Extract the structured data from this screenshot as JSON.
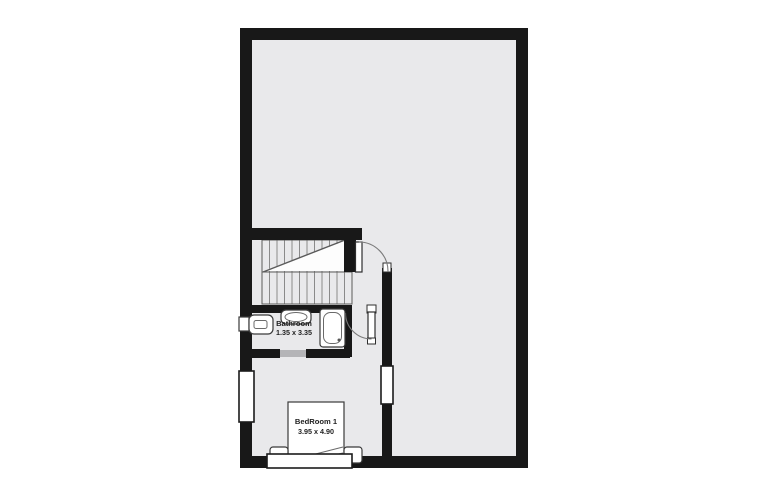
{
  "canvas": {
    "background": "#ffffff"
  },
  "colors": {
    "wall": "#181818",
    "floor": "#e9e9eb",
    "stair_fill": "#fdfdfd",
    "opening": "#b4b4b7"
  },
  "rooms": [
    {
      "name": "Bathroom",
      "dimensions": "1.35 x 3.35"
    },
    {
      "name": "BedRoom 1",
      "dimensions": "3.95 x 4.90"
    }
  ]
}
